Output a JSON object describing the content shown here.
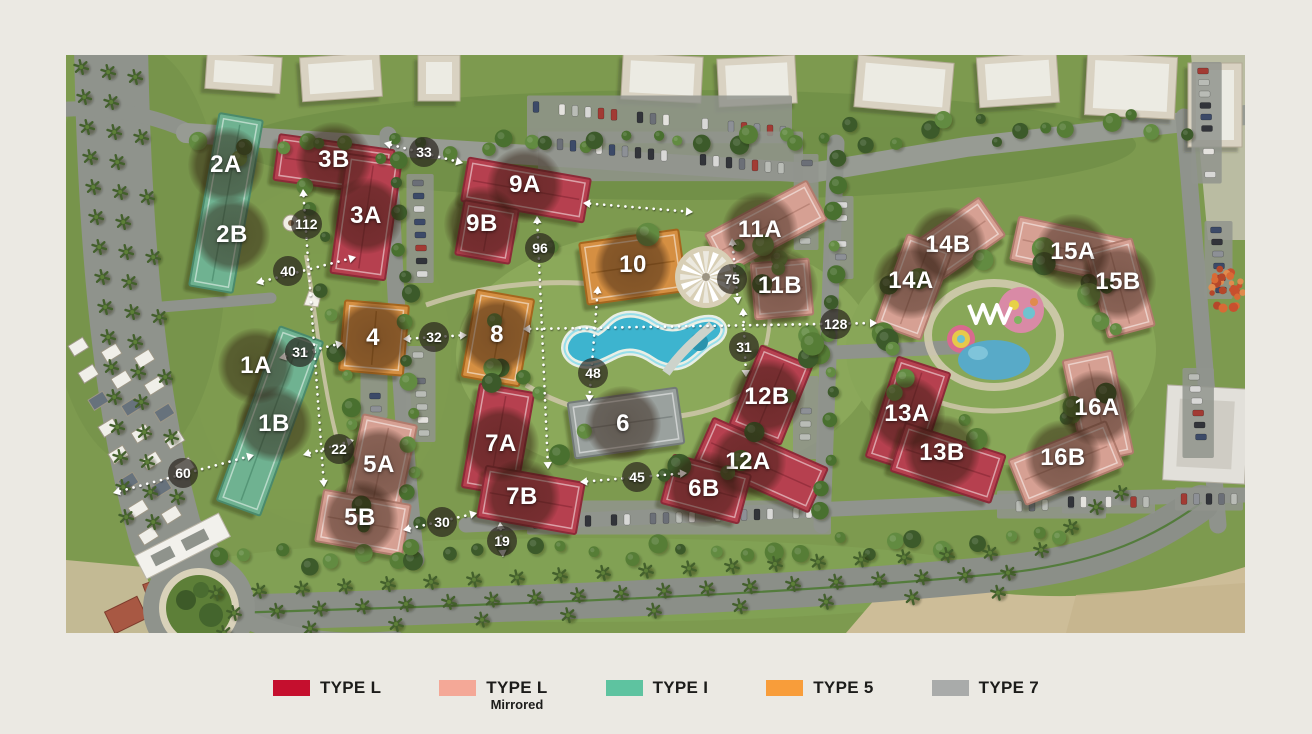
{
  "page": {
    "background": "#ebe9e3"
  },
  "map": {
    "description": "Residential compound master plan aerial view",
    "buildings": [
      {
        "label": "2A",
        "type": "TYPE I",
        "x": 160,
        "y": 110
      },
      {
        "label": "2B",
        "type": "TYPE I",
        "x": 166,
        "y": 180
      },
      {
        "label": "3B",
        "type": "TYPE L",
        "x": 268,
        "y": 105
      },
      {
        "label": "3A",
        "type": "TYPE L",
        "x": 300,
        "y": 161
      },
      {
        "label": "9A",
        "type": "TYPE L",
        "x": 459,
        "y": 130
      },
      {
        "label": "9B",
        "type": "TYPE L",
        "x": 416,
        "y": 169
      },
      {
        "label": "10",
        "type": "TYPE 5",
        "x": 567,
        "y": 210
      },
      {
        "label": "11A",
        "type": "TYPE L Mirrored",
        "x": 694,
        "y": 175
      },
      {
        "label": "11B",
        "type": "TYPE L Mirrored",
        "x": 714,
        "y": 231
      },
      {
        "label": "14B",
        "type": "TYPE L Mirrored",
        "x": 882,
        "y": 190
      },
      {
        "label": "14A",
        "type": "TYPE L Mirrored",
        "x": 845,
        "y": 226
      },
      {
        "label": "15A",
        "type": "TYPE L Mirrored",
        "x": 1007,
        "y": 197
      },
      {
        "label": "15B",
        "type": "TYPE L Mirrored",
        "x": 1052,
        "y": 227
      },
      {
        "label": "1A",
        "type": "TYPE I",
        "x": 190,
        "y": 311
      },
      {
        "label": "4",
        "type": "TYPE 5",
        "x": 307,
        "y": 283
      },
      {
        "label": "8",
        "type": "TYPE 5",
        "x": 431,
        "y": 280
      },
      {
        "label": "1B",
        "type": "TYPE I",
        "x": 208,
        "y": 369
      },
      {
        "label": "12B",
        "type": "TYPE L",
        "x": 701,
        "y": 342
      },
      {
        "label": "6",
        "type": "TYPE 7",
        "x": 557,
        "y": 369
      },
      {
        "label": "13A",
        "type": "TYPE L",
        "x": 841,
        "y": 359
      },
      {
        "label": "13B",
        "type": "TYPE L",
        "x": 876,
        "y": 398
      },
      {
        "label": "16A",
        "type": "TYPE L Mirrored",
        "x": 1031,
        "y": 353
      },
      {
        "label": "16B",
        "type": "TYPE L Mirrored",
        "x": 997,
        "y": 403
      },
      {
        "label": "5A",
        "type": "TYPE L Mirrored",
        "x": 313,
        "y": 410
      },
      {
        "label": "5B",
        "type": "TYPE L Mirrored",
        "x": 294,
        "y": 463
      },
      {
        "label": "7A",
        "type": "TYPE L",
        "x": 435,
        "y": 389
      },
      {
        "label": "7B",
        "type": "TYPE L",
        "x": 456,
        "y": 442
      },
      {
        "label": "12A",
        "type": "TYPE L",
        "x": 682,
        "y": 407
      },
      {
        "label": "6B",
        "type": "TYPE L",
        "x": 638,
        "y": 434
      }
    ],
    "measurements": [
      {
        "label": "33",
        "x1": 318,
        "y1": 88,
        "x2": 397,
        "y2": 108,
        "lx": 358,
        "ly": 97
      },
      {
        "label": "112",
        "x1": 237,
        "y1": 134,
        "x2": 258,
        "y2": 432,
        "lx": 240,
        "ly": 169
      },
      {
        "label": "40",
        "x1": 190,
        "y1": 228,
        "x2": 290,
        "y2": 202,
        "lx": 222,
        "ly": 216
      },
      {
        "label": "31",
        "x1": 213,
        "y1": 303,
        "x2": 277,
        "y2": 288,
        "lx": 234,
        "ly": 297
      },
      {
        "label": "32",
        "x1": 337,
        "y1": 284,
        "x2": 401,
        "y2": 280,
        "lx": 368,
        "ly": 282
      },
      {
        "label": "96",
        "x1": 471,
        "y1": 161,
        "x2": 482,
        "y2": 414,
        "lx": 474,
        "ly": 193
      },
      {
        "label": "48",
        "x1": 532,
        "y1": 231,
        "x2": 523,
        "y2": 347,
        "lx": 527,
        "ly": 318
      },
      {
        "label": "75",
        "x1": 666,
        "y1": 183,
        "x2": 672,
        "y2": 249,
        "lx": 666,
        "ly": 224
      },
      {
        "label": "31",
        "x1": 677,
        "y1": 253,
        "x2": 680,
        "y2": 322,
        "lx": 678,
        "ly": 292
      },
      {
        "label": "128",
        "x1": 457,
        "y1": 274,
        "x2": 811,
        "y2": 268,
        "lx": 769,
        "ly": 269
      },
      {
        "label": "",
        "x1": 517,
        "y1": 148,
        "x2": 627,
        "y2": 157,
        "lx": 571,
        "ly": 152
      },
      {
        "label": "22",
        "x1": 237,
        "y1": 400,
        "x2": 288,
        "y2": 385,
        "lx": 273,
        "ly": 394
      },
      {
        "label": "60",
        "x1": 47,
        "y1": 438,
        "x2": 188,
        "y2": 400,
        "lx": 117,
        "ly": 418
      },
      {
        "label": "45",
        "x1": 514,
        "y1": 427,
        "x2": 621,
        "y2": 418,
        "lx": 571,
        "ly": 422
      },
      {
        "label": "30",
        "x1": 337,
        "y1": 475,
        "x2": 411,
        "y2": 458,
        "lx": 376,
        "ly": 467
      },
      {
        "label": "19",
        "x1": 434,
        "y1": 467,
        "x2": 437,
        "y2": 502,
        "lx": 436,
        "ly": 486
      }
    ]
  },
  "legend": {
    "items": [
      {
        "label": "TYPE L",
        "sublabel": "",
        "color": "#c50f2e"
      },
      {
        "label": "TYPE L",
        "sublabel": "Mirrored",
        "color": "#f4a897"
      },
      {
        "label": "TYPE I",
        "sublabel": "",
        "color": "#5ec3a0"
      },
      {
        "label": "TYPE 5",
        "sublabel": "",
        "color": "#f89d3a"
      },
      {
        "label": "TYPE 7",
        "sublabel": "",
        "color": "#a9abaa"
      }
    ]
  }
}
